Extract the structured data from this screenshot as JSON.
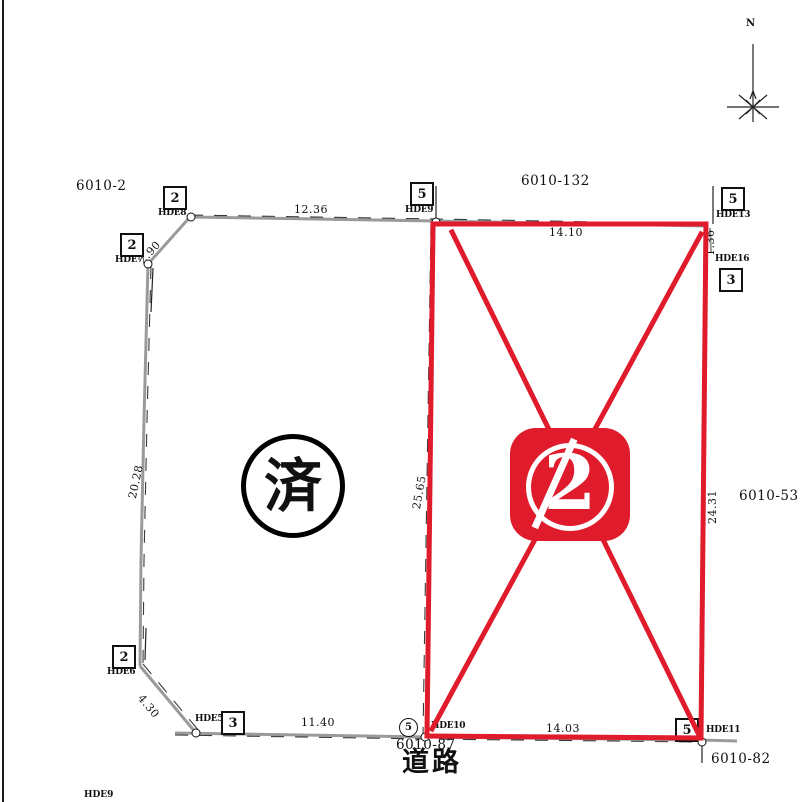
{
  "colors": {
    "red": "#e01b2b",
    "line_gray": "#9a9a9a",
    "ink": "#111111"
  },
  "compass": {
    "north_label": "N"
  },
  "road": {
    "label": "道路"
  },
  "stamps": {
    "done_circle": {
      "text": "済"
    },
    "sold_badge": {
      "number": "2"
    }
  },
  "parcel_labels": [
    {
      "text": "6010-2",
      "x": 76,
      "y": 178
    },
    {
      "text": "6010-132",
      "x": 521,
      "y": 173
    },
    {
      "text": "6010-53",
      "x": 739,
      "y": 488
    },
    {
      "text": "6010-82",
      "x": 711,
      "y": 751
    },
    {
      "text": "6010-87",
      "x": 396,
      "y": 737
    }
  ],
  "dimension_labels": [
    {
      "text": "12.36",
      "x": 294,
      "y": 203,
      "rot": 0
    },
    {
      "text": "2.90",
      "x": 136,
      "y": 258,
      "rot": -48
    },
    {
      "text": "14.10",
      "x": 549,
      "y": 226,
      "rot": 0
    },
    {
      "text": "1.36",
      "x": 704,
      "y": 256,
      "rot": -90
    },
    {
      "text": "20.28",
      "x": 126,
      "y": 497,
      "rot": -78
    },
    {
      "text": "25.65",
      "x": 410,
      "y": 508,
      "rot": -80
    },
    {
      "text": "24.31",
      "x": 706,
      "y": 524,
      "rot": -90
    },
    {
      "text": "4.30",
      "x": 145,
      "y": 692,
      "rot": 50
    },
    {
      "text": "11.40",
      "x": 301,
      "y": 716,
      "rot": 0
    },
    {
      "text": "14.03",
      "x": 546,
      "y": 722,
      "rot": 0,
      "under": true
    }
  ],
  "survey_markers": [
    {
      "num": "2",
      "x": 163,
      "y": 186,
      "label": "HDE8",
      "lx": 158,
      "ly": 208
    },
    {
      "num": "2",
      "x": 120,
      "y": 233,
      "label": "HDE7",
      "lx": 115,
      "ly": 255
    },
    {
      "num": "5",
      "x": 410,
      "y": 182,
      "label": "HDE9",
      "lx": 405,
      "ly": 205
    },
    {
      "num": "5",
      "x": 721,
      "y": 187,
      "label": "HDE13",
      "lx": 716,
      "ly": 210
    },
    {
      "num": "3",
      "x": 719,
      "y": 268,
      "label": "HDE16",
      "lx": 715,
      "ly": 254
    },
    {
      "num": "2",
      "x": 112,
      "y": 645,
      "label": "HDE6",
      "lx": 107,
      "ly": 667
    },
    {
      "num": "3",
      "x": 221,
      "y": 711,
      "label": "HDE5",
      "lx": 195,
      "ly": 714
    },
    {
      "num": "5",
      "x": 675,
      "y": 718,
      "label": "HDE11",
      "lx": 706,
      "ly": 725,
      "under": true
    }
  ],
  "circle_marker": {
    "num": "5",
    "x": 399,
    "y": 718,
    "label": "HDE10",
    "lx": 431,
    "ly": 721
  },
  "point_circles": [
    [
      191,
      217
    ],
    [
      148,
      264
    ],
    [
      436,
      222
    ],
    [
      196,
      733
    ],
    [
      425,
      737
    ],
    [
      702,
      742
    ]
  ],
  "edge_label": {
    "text": "HDE9",
    "x": 84,
    "y": 790
  }
}
